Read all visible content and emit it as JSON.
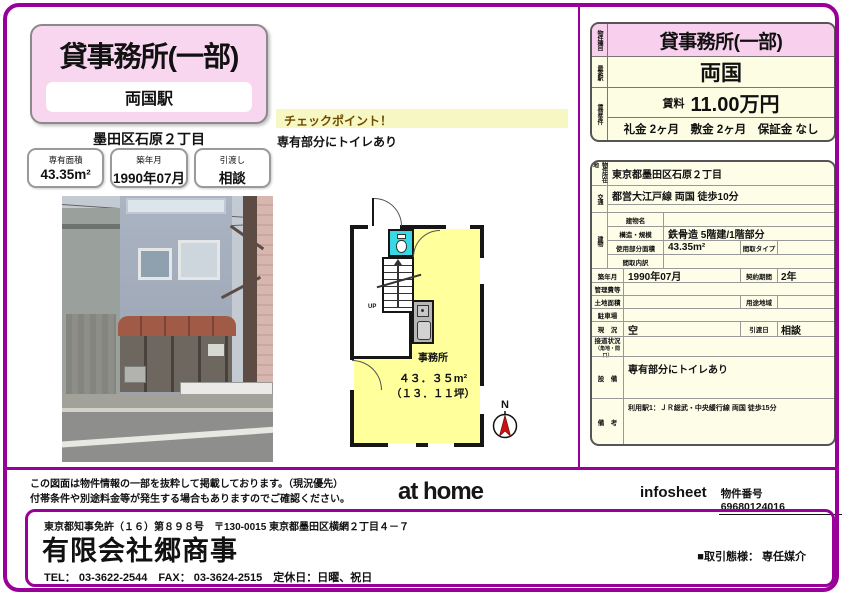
{
  "colors": {
    "accent": "#990099",
    "title_bg": "#f8d6f0",
    "highlight_pink": "#f8d0ee",
    "table_bg": "#fdfde8",
    "checkpoint_bg": "#f7f7c3",
    "room_yellow": "#ffff9c",
    "toilet_cyan": "#38d8e4",
    "compass_red": "#cc1111"
  },
  "header": {
    "title": "貸事務所(一部)",
    "station": "両国駅",
    "address": "墨田区石原２丁目",
    "stats": [
      {
        "label": "専有面積",
        "value": "43.35m²"
      },
      {
        "label": "築年月",
        "value": "1990年07月"
      },
      {
        "label": "引渡し",
        "value": "相談"
      }
    ]
  },
  "checkpoint": {
    "title": "チェックポイント！",
    "body": "専有部分にトイレあり"
  },
  "floorplan": {
    "room_label": "事務所",
    "area": "４３．３５m²",
    "tsubo": "（１３．１１坪）",
    "up_label": "UP",
    "north_label": "N"
  },
  "summary": {
    "side_labels": {
      "type": "物件種目",
      "station": "最寄駅",
      "terms": "賃貸条件"
    },
    "type": "貸事務所(一部)",
    "station": "両国",
    "rent_label": "賃料",
    "rent_value": "11.00万円",
    "terms": "礼金 2ヶ月　敷金 2ヶ月　保証金 なし"
  },
  "details": {
    "location": {
      "label": "物件所在地",
      "value": "東京都墨田区石原２丁目"
    },
    "access": {
      "label": "交通",
      "value": "都営大江戸線 両国 徒歩10分"
    },
    "building": {
      "group_label": "建物",
      "name": {
        "label": "建物名",
        "value": ""
      },
      "structure": {
        "label": "構造・規模",
        "value": "鉄骨造 5階建/1階部分"
      },
      "area": {
        "label": "使用部分面積",
        "value": "43.35m²",
        "label2": "間取タイプ",
        "value2": ""
      },
      "layout": {
        "label": "間取内訳",
        "value": ""
      }
    },
    "built": {
      "label": "築年月",
      "value": "1990年07月",
      "label2": "契約期間",
      "value2": "2年"
    },
    "management": {
      "label": "管理費等",
      "value": ""
    },
    "land": {
      "label": "土地面積",
      "value": "",
      "label2": "用途地域",
      "value2": ""
    },
    "parking": {
      "label": "駐車場",
      "value": ""
    },
    "status": {
      "label": "現　況",
      "value": "空",
      "label2": "引渡日",
      "value2": "相談"
    },
    "road": {
      "label": "接道状況",
      "sublabel": "（角地・間口）",
      "value": ""
    },
    "equipment": {
      "label": "設　備",
      "value": "専有部分にトイレあり"
    },
    "remarks": {
      "label": "備　考",
      "value": "利用駅1：ＪＲ総武・中央緩行線 両国 徒歩15分"
    }
  },
  "footer": {
    "disclaimer_line1": "この図面は物件情報の一部を抜粋して掲載しております。（現況優先）",
    "disclaimer_line2": "付帯条件や別途料金等が発生する場合もありますのでご確認ください。",
    "logo": "at home",
    "infosheet_label": "infosheet",
    "property_number_label": "物件番号",
    "property_number": "69680124016"
  },
  "company": {
    "license": "東京都知事免許（１６）第８９８号　〒130-0015 東京都墨田区横網２丁目４－７",
    "name": "有限会社郷商事",
    "contact": "TEL： 03-3622-2544　FAX： 03-3624-2515　定休日：日曜、祝日",
    "transaction": "■取引態様： 専任媒介"
  }
}
